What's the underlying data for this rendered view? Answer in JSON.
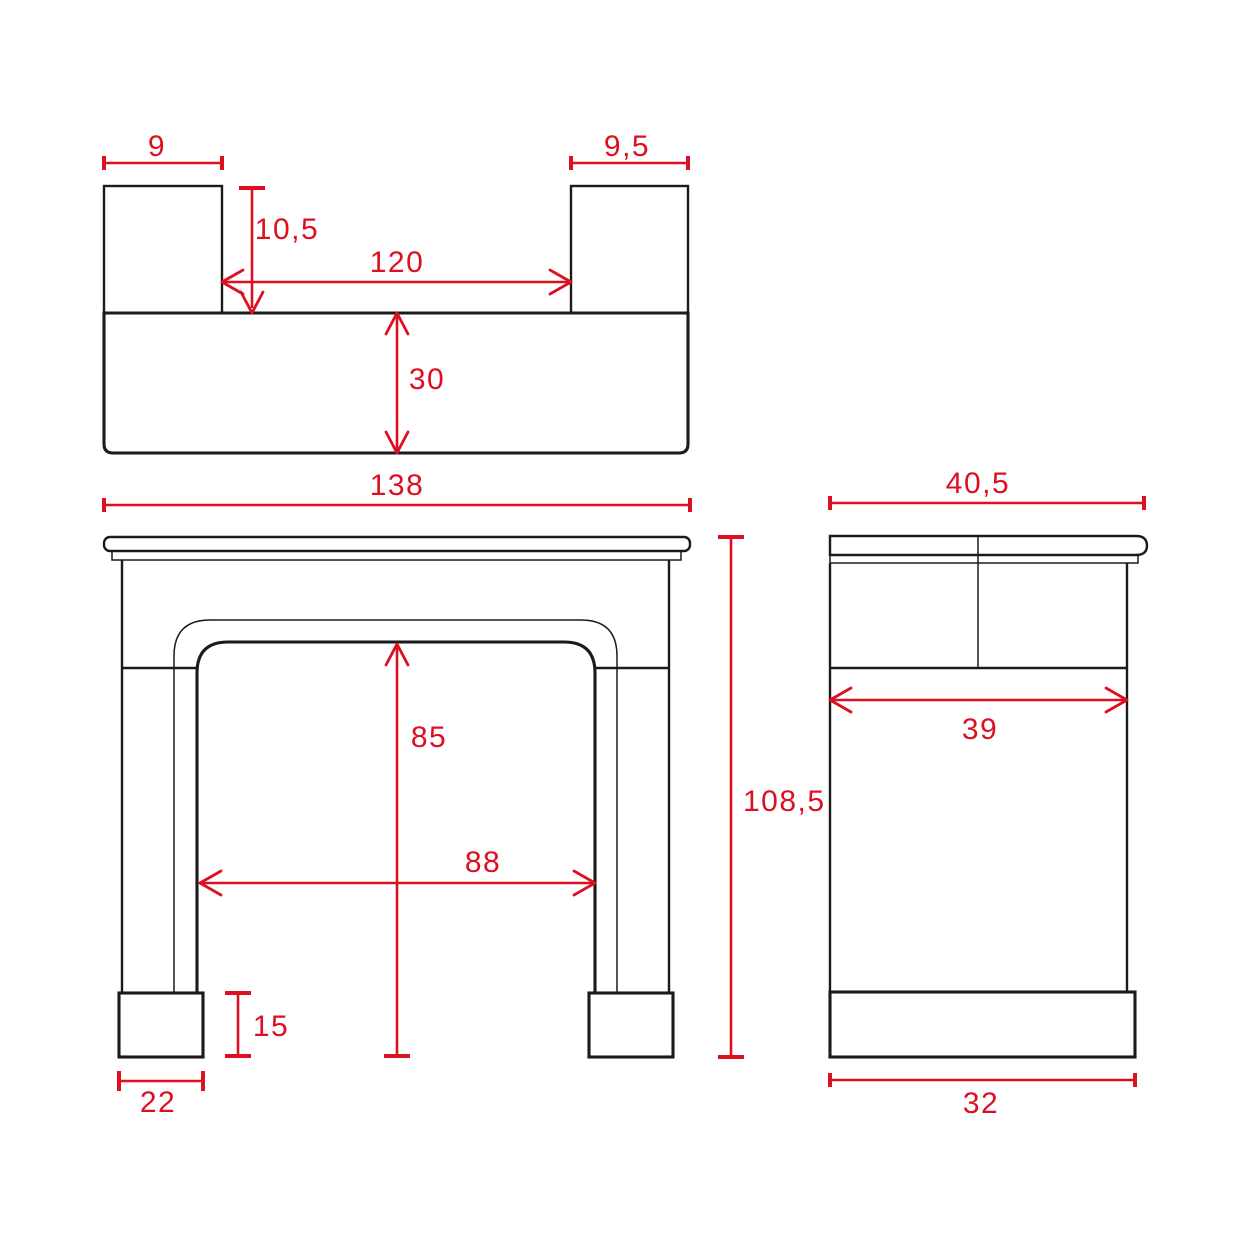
{
  "drawing": {
    "type": "technical-drawing-fireplace-mantel",
    "colors": {
      "dimension_red": "#dc1021",
      "line_black": "#1b1b1b",
      "background": "#ffffff"
    },
    "views": {
      "plan": {
        "dimensions": {
          "left_leg_width": "9",
          "right_leg_width": "9,5",
          "leg_depth": "10,5",
          "inner_width": "120",
          "shelf_depth": "30"
        }
      },
      "front": {
        "dimensions": {
          "overall_width": "138",
          "opening_height": "85",
          "opening_width": "88",
          "plinth_height": "15",
          "plinth_width": "22",
          "overall_height": "108,5"
        }
      },
      "side": {
        "dimensions": {
          "shelf_depth_overall": "40,5",
          "body_depth": "39",
          "plinth_depth": "32"
        }
      }
    }
  }
}
